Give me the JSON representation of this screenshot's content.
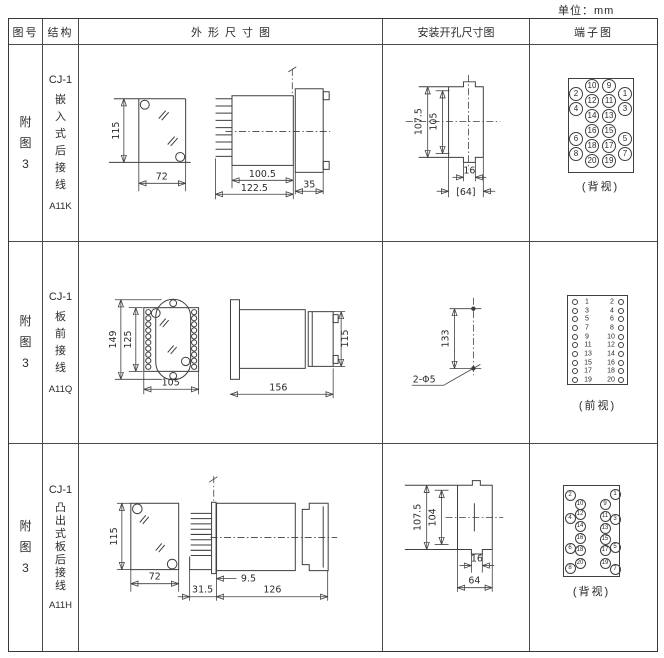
{
  "unit_label": "单位：mm",
  "colors": {
    "line": "#3f3f3f",
    "text": "#2b2b2b",
    "bg": "#ffffff"
  },
  "header": {
    "fig_no": "图号",
    "structure": "结构",
    "outline": "外形尺寸图",
    "mounting": "安装开孔尺寸图",
    "terminal": "端子图"
  },
  "rows": [
    {
      "fig_no": "附图3",
      "model": "CJ-1",
      "structure": "嵌入式后接线",
      "code": "A11K",
      "outline_dims": {
        "front_height": "115",
        "front_width": "72",
        "body_length": "100.5",
        "total_length": "122.5",
        "flange_depth": "35"
      },
      "mounting_dims": {
        "outer_height": "107.5",
        "inner_height": "105",
        "notch_width": "16",
        "cutout_width": "[64]"
      },
      "terminal_view": {
        "label": "(背视)",
        "box": {
          "x": 38,
          "y": 33,
          "w": 66,
          "h": 95
        },
        "r": 7,
        "fs": 8,
        "circles": [
          {
            "n": "10",
            "x": 23,
            "y": 7
          },
          {
            "n": "9",
            "x": 40,
            "y": 7
          },
          {
            "n": "2",
            "x": 7,
            "y": 15
          },
          {
            "n": "12",
            "x": 23,
            "y": 22
          },
          {
            "n": "11",
            "x": 40,
            "y": 22
          },
          {
            "n": "1",
            "x": 56,
            "y": 15
          },
          {
            "n": "4",
            "x": 7,
            "y": 30
          },
          {
            "n": "14",
            "x": 23,
            "y": 37
          },
          {
            "n": "13",
            "x": 40,
            "y": 37
          },
          {
            "n": "3",
            "x": 56,
            "y": 30
          },
          {
            "n": "6",
            "x": 7,
            "y": 60
          },
          {
            "n": "16",
            "x": 23,
            "y": 52
          },
          {
            "n": "15",
            "x": 40,
            "y": 52
          },
          {
            "n": "5",
            "x": 56,
            "y": 60
          },
          {
            "n": "8",
            "x": 7,
            "y": 75
          },
          {
            "n": "18",
            "x": 23,
            "y": 67
          },
          {
            "n": "17",
            "x": 40,
            "y": 67
          },
          {
            "n": "7",
            "x": 56,
            "y": 75
          },
          {
            "n": "20",
            "x": 23,
            "y": 82
          },
          {
            "n": "19",
            "x": 40,
            "y": 82
          }
        ]
      }
    },
    {
      "fig_no": "附图3",
      "model": "CJ-1",
      "structure": "板前接线",
      "code": "A11Q",
      "outline_dims": {
        "plate_height": "149",
        "body_height": "125",
        "front_width": "105",
        "total_length": "156",
        "rear_height": "115"
      },
      "mounting_dims": {
        "hole_spacing": "133",
        "hole_spec": "2-Φ5"
      },
      "terminal_view": {
        "label": "(前视)",
        "box": {
          "x": 37,
          "y": 53,
          "w": 61,
          "h": 90
        },
        "r": 3.2,
        "fs": 7,
        "circles": [
          {
            "x": 7,
            "y": 6
          },
          {
            "x": 7,
            "y": 15
          },
          {
            "x": 7,
            "y": 23
          },
          {
            "x": 7,
            "y": 32
          },
          {
            "x": 7,
            "y": 41
          },
          {
            "x": 7,
            "y": 49
          },
          {
            "x": 7,
            "y": 58
          },
          {
            "x": 7,
            "y": 67
          },
          {
            "x": 7,
            "y": 75
          },
          {
            "x": 7,
            "y": 84
          },
          {
            "x": 53,
            "y": 6
          },
          {
            "x": 53,
            "y": 15
          },
          {
            "x": 53,
            "y": 23
          },
          {
            "x": 53,
            "y": 32
          },
          {
            "x": 53,
            "y": 41
          },
          {
            "x": 53,
            "y": 49
          },
          {
            "x": 53,
            "y": 58
          },
          {
            "x": 53,
            "y": 67
          },
          {
            "x": 53,
            "y": 75
          },
          {
            "x": 53,
            "y": 84
          }
        ],
        "texts": [
          {
            "n": "1",
            "x": 19,
            "y": 6
          },
          {
            "n": "3",
            "x": 19,
            "y": 15
          },
          {
            "n": "5",
            "x": 19,
            "y": 23
          },
          {
            "n": "7",
            "x": 19,
            "y": 32
          },
          {
            "n": "9",
            "x": 19,
            "y": 41
          },
          {
            "n": "11",
            "x": 20,
            "y": 49
          },
          {
            "n": "13",
            "x": 20,
            "y": 58
          },
          {
            "n": "15",
            "x": 20,
            "y": 67
          },
          {
            "n": "17",
            "x": 20,
            "y": 75
          },
          {
            "n": "19",
            "x": 20,
            "y": 84
          },
          {
            "n": "2",
            "x": 44,
            "y": 6
          },
          {
            "n": "4",
            "x": 44,
            "y": 15
          },
          {
            "n": "6",
            "x": 44,
            "y": 23
          },
          {
            "n": "8",
            "x": 44,
            "y": 32
          },
          {
            "n": "10",
            "x": 43,
            "y": 41
          },
          {
            "n": "12",
            "x": 43,
            "y": 49
          },
          {
            "n": "14",
            "x": 43,
            "y": 58
          },
          {
            "n": "16",
            "x": 43,
            "y": 67
          },
          {
            "n": "18",
            "x": 43,
            "y": 75
          },
          {
            "n": "20",
            "x": 43,
            "y": 84
          }
        ]
      }
    },
    {
      "fig_no": "附图3",
      "model": "CJ-1",
      "structure": "凸出式板后接线",
      "code": "A11H",
      "outline_dims": {
        "front_height": "115",
        "front_width": "72",
        "pin_offset": "31.5",
        "stud_offset": "9.5",
        "body_length": "126"
      },
      "mounting_dims": {
        "outer_height": "107.5",
        "inner_height": "104",
        "notch_width": "16",
        "cutout_width": "64"
      },
      "terminal_view": {
        "label": "(背视)",
        "box": {
          "x": 33,
          "y": 41,
          "w": 57,
          "h": 92
        },
        "r": 5.5,
        "fs": 6,
        "circles": [
          {
            "n": "2",
            "x": 6,
            "y": 9
          },
          {
            "n": "1",
            "x": 51,
            "y": 8
          },
          {
            "n": "10",
            "x": 16,
            "y": 18
          },
          {
            "n": "9",
            "x": 41,
            "y": 18
          },
          {
            "n": "12",
            "x": 16,
            "y": 28
          },
          {
            "n": "11",
            "x": 41,
            "y": 30
          },
          {
            "n": "4",
            "x": 6,
            "y": 32
          },
          {
            "n": "3",
            "x": 51,
            "y": 33
          },
          {
            "n": "14",
            "x": 16,
            "y": 40
          },
          {
            "n": "13",
            "x": 41,
            "y": 42
          },
          {
            "n": "16",
            "x": 16,
            "y": 52
          },
          {
            "n": "15",
            "x": 41,
            "y": 53
          },
          {
            "n": "6",
            "x": 6,
            "y": 62
          },
          {
            "n": "5",
            "x": 51,
            "y": 61
          },
          {
            "n": "18",
            "x": 16,
            "y": 64
          },
          {
            "n": "17",
            "x": 41,
            "y": 64
          },
          {
            "n": "20",
            "x": 16,
            "y": 77
          },
          {
            "n": "19",
            "x": 41,
            "y": 77
          },
          {
            "n": "8",
            "x": 6,
            "y": 82
          },
          {
            "n": "7",
            "x": 51,
            "y": 83
          }
        ]
      }
    }
  ]
}
